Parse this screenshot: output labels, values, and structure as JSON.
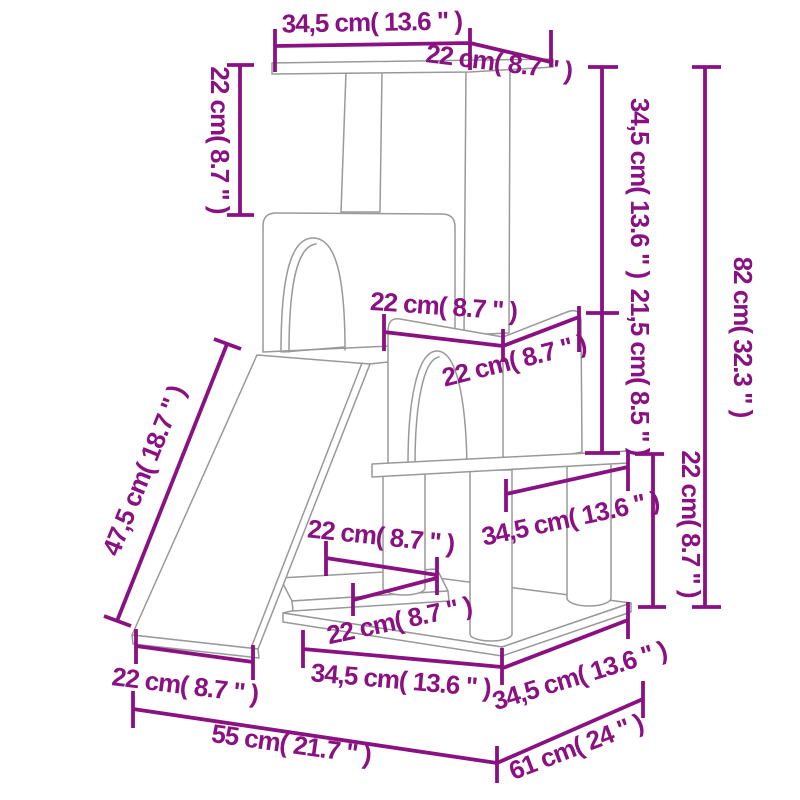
{
  "diagram": {
    "kind": "product-dimension-drawing",
    "subject": "cat-tree-with-scratching-posts",
    "background": "#ffffff",
    "outline_color": "#999999",
    "dimension_color": "#8A1182",
    "labels": {
      "top_platform_width": "34,5 cm( 13.6 \" )",
      "top_platform_depth": "22 cm( 8.7 \" )",
      "top_post_height": "22 cm( 8.7 \" )",
      "upper_section_height": "34,5 cm( 13.6 \" )",
      "house_section_height": "21,5 cm( 8.5 \" )",
      "lower_section_height": "22 cm( 8.7 \" )",
      "total_height": "82 cm( 32.3 \" )",
      "house_width": "22 cm( 8.7 \" )",
      "house_depth": "22 cm( 8.7 \" )",
      "middle_platform_width": "34,5 cm( 13.6 \" )",
      "step_width": "22 cm( 8.7 \" )",
      "step_depth": "22 cm( 8.7 \" )",
      "base_width": "34,5 cm( 13.6 \" )",
      "base_depth": "34,5 cm( 13.6 \" )",
      "ramp_width": "22 cm( 8.7 \" )",
      "ramp_length": "47,5 cm( 18.7 \" )",
      "overall_width": "55 cm( 21.7 \" )",
      "overall_depth": "61 cm( 24 \" )"
    }
  }
}
